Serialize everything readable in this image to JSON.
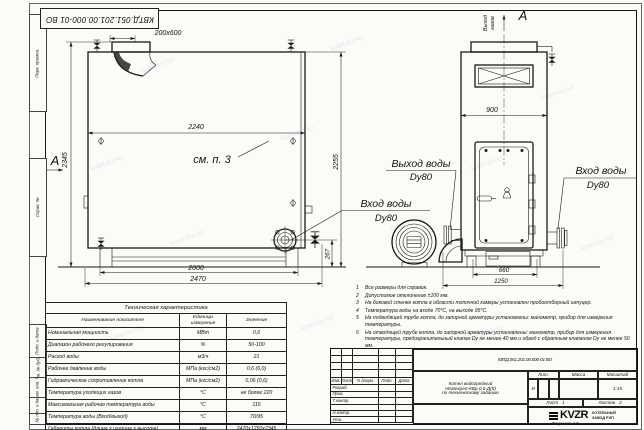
{
  "watermark": "kotel-kvr.kz",
  "stamp_code": "КВТД.051.201.00.000-01 ВО",
  "side_column": {
    "labels": [
      "Перв. примен.",
      "Справ. №",
      "Подп. и дата",
      "Инв. № дубл.",
      "Взам. инв. №",
      "Подп. и дата",
      "Инв. № подл."
    ]
  },
  "left_view": {
    "section_letter": "А",
    "see_note": "см. п. 3",
    "dim_duct": "200x600",
    "dim_width": "2240",
    "dim_height_left": "2345",
    "dim_height_right": "2255",
    "dim_flange": "267",
    "dim_base_inner": "2000",
    "dim_base_outer": "2470",
    "inlet_label": "Вход воды",
    "inlet_dn": "Dy80"
  },
  "right_view": {
    "view_letter": "А",
    "flue_word_1": "Выход",
    "flue_word_2": "газов",
    "dim_width": "900",
    "dim_base_inner": "660",
    "dim_base_outer": "1250",
    "outlet_label": "Выход воды",
    "outlet_dn": "Dy80",
    "inlet_label": "Вход воды",
    "inlet_dn": "Dy80"
  },
  "notes": [
    {
      "n": "1",
      "text": "Все размеры для справок."
    },
    {
      "n": "2",
      "text": "Допустимое отклонение ±100 мм."
    },
    {
      "n": "3",
      "text": "На боковой стенке котла в области топочной камеры установлен пробоотборный штуцер."
    },
    {
      "n": "4",
      "text": "Температура воды на входе 70°С, на выходе 95°С."
    },
    {
      "n": "5",
      "text": "На подводящей трубе котла, до запорной арматуры установлены: манометр, прибор для измерения температуры."
    },
    {
      "n": "6",
      "text": "На отводящей трубе котла, до запорной арматуры установлены: манометр, прибор для измерения температуры, предохранительный клапан Dу не менее 40 мм и обвод с обратным клапаном Dу не менее 50 мм."
    },
    {
      "n": "7",
      "text": "Остальные технические требования по ОСТ 108.030.133-84."
    }
  ],
  "tech_table": {
    "title": "Техническая характеристика",
    "headers": [
      "Наименование показателя",
      "Единицы измерения",
      "Значение"
    ],
    "rows": [
      [
        "Номинальная мощность",
        "МВт",
        "0,6"
      ],
      [
        "Диапазон рабочего регулирования",
        "%",
        "50-100"
      ],
      [
        "Расход воды",
        "м3/ч",
        "21"
      ],
      [
        "Рабочее давление воды",
        "МПа (кгс/см2)",
        "0,6 (6,0)"
      ],
      [
        "Гидравлическое сопротивление котла",
        "МПа (кгс/см2)",
        "0,06 (0,6)"
      ],
      [
        "Температура уходящих газов",
        "°С",
        "не более 220"
      ],
      [
        "Максимальная рабочая температура воды",
        "°С",
        "115"
      ],
      [
        "Температура воды (Вход/выход)",
        "°С",
        "70/95"
      ],
      [
        "Габариты котла (длина х ширина х высота)",
        "мм",
        "2470х1250х2345"
      ]
    ]
  },
  "title_block": {
    "doc_number": "КВТД.051.201.00.000-01 ВО",
    "name_lines": [
      "Котел водогрейный",
      "Heatexpert-КВр-0,6-Д(К)",
      "по техническому заданию"
    ],
    "header_cols": [
      "Изм.",
      "Лист",
      "N докум.",
      "Подп.",
      "Дата"
    ],
    "row_labels": [
      "Разраб.",
      "Пров.",
      "Т.контр.",
      "Н.контр.",
      "Утв."
    ],
    "lit_label": "Лит.",
    "mass_label": "Масса",
    "scale_label": "Масштаб",
    "lit_value": "И",
    "scale_value": "1:15",
    "sheet_label": "Лист",
    "sheet_value": "1",
    "sheets_label": "Листов",
    "sheets_value": "2",
    "logo_text": "KVZR",
    "company_lines": [
      "КОТЕЛЬНЫЙ",
      "ЗАВОД РЭП"
    ],
    "format_note": "Формат А3"
  }
}
